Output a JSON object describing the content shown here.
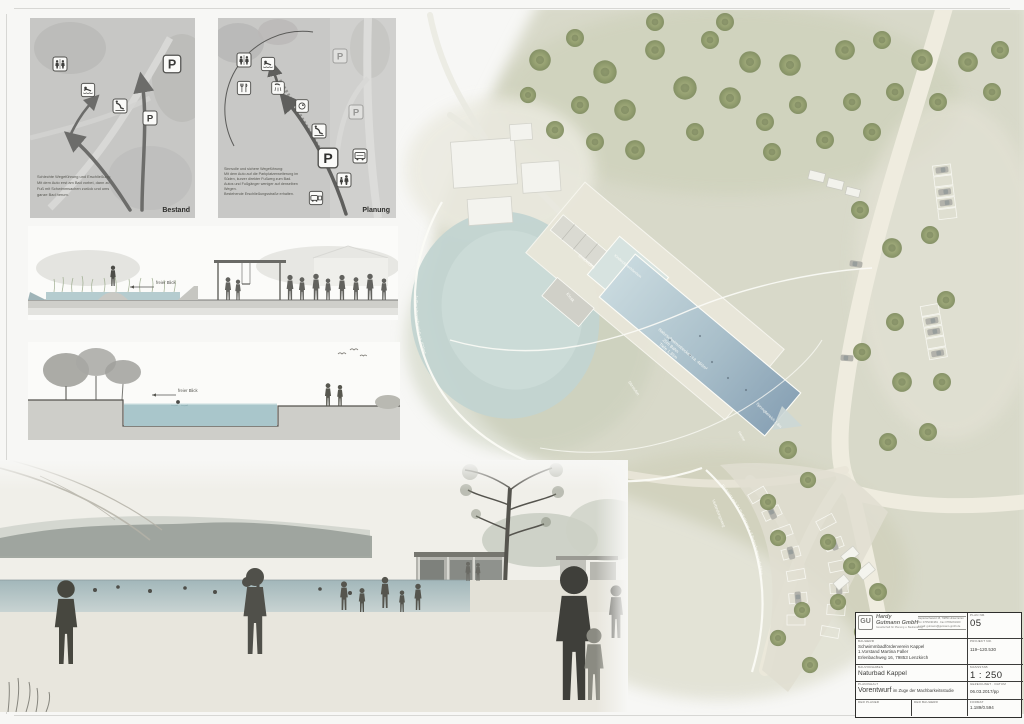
{
  "colors": {
    "water": "#b9cedb",
    "tree_green": "#8e9a69",
    "plan_base": "#d9dacb",
    "ink": "#3c3c3a"
  },
  "maps": {
    "p_sign": "P",
    "bestand": {
      "label": "Bestand",
      "caption": [
        "Schlechte Wegeführung und Erschließung:",
        "Mit dem Auto erst am Bad vorbei, dann zu",
        "Fuß mit Schwimmsachen zurück und ums",
        "ganze Bad herum."
      ]
    },
    "planung": {
      "label": "Planung",
      "caption": [
        "Sinnvolle und sichere Wegeführung:",
        "Mit dem Auto auf die Parkplatzerweiterung im",
        "Süden, kurzer direkter Fußweg zum Bad.",
        "Autos und Fußgänger weniger auf denselben",
        "Wegen.",
        "Bestehende Erschließungsstraße erhalten."
      ]
    }
  },
  "sections": {
    "view_label": "freier Blick"
  },
  "site_plan": {
    "labels": {
      "umkleiden": "Umkleiden",
      "kiosk": "Kiosk",
      "kinderbecken": "Kinderplanschbecken",
      "aufbereitung": "Aufbereitungsbereich ca. 620m²",
      "pool_line1": "Naturschwimmbecken ca. 460m²",
      "pool_line2": "25m Bahn",
      "pool_line3": "Tiefe 1,35m",
      "sitzstufen": "Sitzstufen",
      "sprungbereich": "Sprungbereich 1,8m",
      "hecke": "Hecke",
      "verbindungsweg": "Verbindungsweg",
      "parkplatz": "Parkplatz mit 34 Stellplätzen + 3 Behindertenparkplätze"
    }
  },
  "title_block": {
    "firm": {
      "monogram": "GU",
      "name_line1": "Hardy",
      "name_line2": "Gutmann GmbH",
      "subtitle": "Gesellschaft für Planung u. Bauberatung",
      "address": "Heptenschwand 15, 79856 Hinterzarten",
      "phone": "Tel. 07652/91981 · Fax 07652/91020",
      "email": "e-mail: gutmann@gutmann-gmbh.de"
    },
    "fields": {
      "plan_nr_label": "PLAN NR.",
      "plan_nr": "05",
      "bauherr_label": "BAUHERR",
      "bauherr_line1": "Schwimmbadförderverein Kappel",
      "bauherr_line2": "1.Vorstand Martina Faller",
      "bauherr_line3": "Erlenbachweg 16, 79853 Lenzkirch",
      "projekt_nr_label": "PROJEKT NR.",
      "projekt_nr": "119–120.530",
      "bauvorhaben_label": "BAUVORHABEN",
      "bauvorhaben": "Naturbad Kappel",
      "massstab_label": "MASSSTAB",
      "massstab": "1 : 250",
      "planinhalt_label": "PLANINHALT",
      "planinhalt_main": "Vorentwurf",
      "planinhalt_rest": "im Zuge der Machbarkeitsstudie",
      "gezeichnet_label": "GEZEICHNET · DATUM",
      "gezeichnet": "06.03.2017/pp",
      "planer_label": "DER PLANER",
      "bauherr_sig_label": "DER BAUHERR",
      "format_label": "FORMAT",
      "format": "1.189/0.594"
    }
  }
}
